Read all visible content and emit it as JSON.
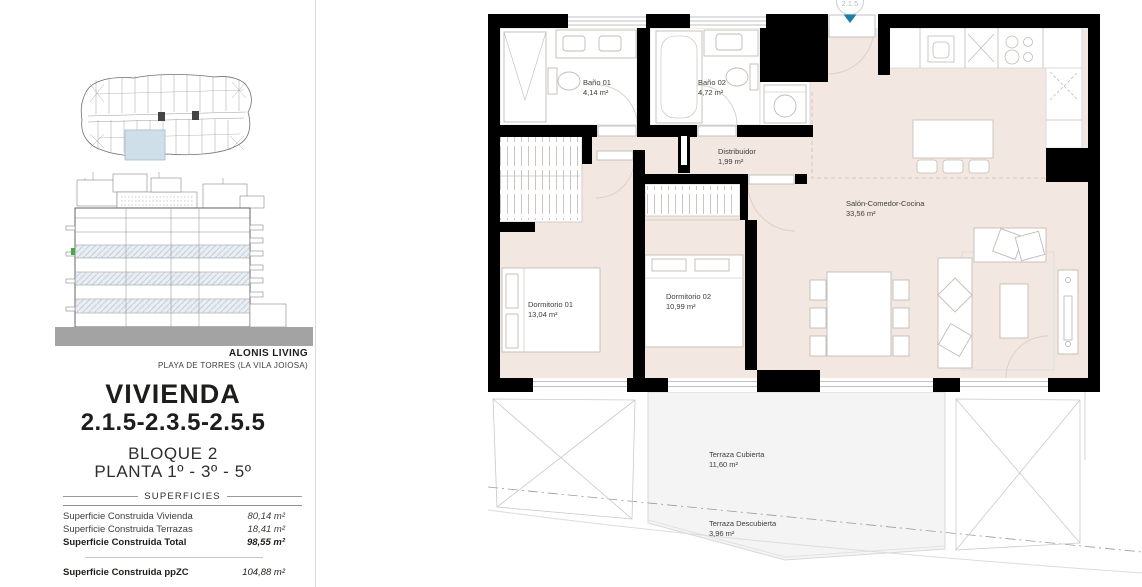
{
  "sidebar": {
    "brand": "ALONIS LIVING",
    "location": "PLAYA DE TORRES (LA VILA JOIOSA)",
    "title": "VIVIENDA",
    "units": "2.1.5-2.3.5-2.5.5",
    "block": "BLOQUE 2",
    "floors": "PLANTA 1º - 3º - 5º",
    "surfaces": {
      "heading": "SUPERFICIES",
      "rows": [
        {
          "label": "Superficie Construida Vivienda",
          "value": "80,14 m²"
        },
        {
          "label": "Superficie Construida Terrazas",
          "value": "18,41 m²"
        },
        {
          "label": "Superficie Construida Total",
          "value": "98,55 m²"
        }
      ],
      "footer": {
        "label": "Superficie Construida ppZC",
        "value": "104,88 m²"
      }
    }
  },
  "plan": {
    "unit_badge": "2.1.5",
    "rooms": [
      {
        "name": "Baño 01",
        "area": "4,14 m²"
      },
      {
        "name": "Baño 02",
        "area": "4,72 m²"
      },
      {
        "name": "Distribuidor",
        "area": "1,99 m²"
      },
      {
        "name": "Salón-Comedor-Cocina",
        "area": "33,56 m²"
      },
      {
        "name": "Dormitorio 01",
        "area": "13,04 m²"
      },
      {
        "name": "Dormitorio 02",
        "area": "10,99 m²"
      },
      {
        "name": "Terraza Cubierta",
        "area": "11,60 m²"
      },
      {
        "name": "Terraza Descubierta",
        "area": "3,96 m²"
      }
    ],
    "colors": {
      "floor": "#f3e8e1",
      "terrace": "#f4f4f4",
      "wall": "#000000",
      "entrance_marker": "#1e7ca8",
      "highlight_unit": "#cfdfe9",
      "elevation_ground": "#a3a3a3",
      "level_marker_green": "#3fae49"
    }
  }
}
